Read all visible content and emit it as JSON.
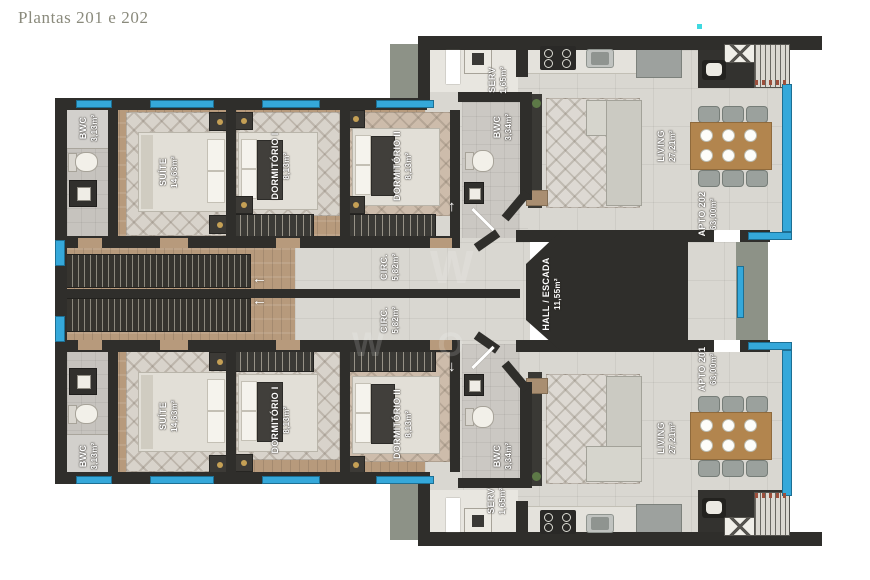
{
  "title": "Plantas 201 e 202",
  "watermark": {
    "emblem": "W",
    "letters": "W O"
  },
  "colors": {
    "wall": "#2f2e2b",
    "glass_blue": "#35a8da",
    "wood_floor": "#b79a7c",
    "tile_floor": "#d9d7d1",
    "concrete": "#a0a599",
    "table_wood": "#b2854e",
    "title_text": "#8a8a7c"
  },
  "units": {
    "apto_202": {
      "name": "APTO 202",
      "area": "63,00m²"
    },
    "apto_201": {
      "name": "APTO 201",
      "area": "63,00m²"
    }
  },
  "rooms": {
    "suite": {
      "name": "SUÍTE",
      "area": "14,63m²"
    },
    "dormitorio1": {
      "name": "DORMITÓRIO I",
      "area": "8,13m²"
    },
    "dormitorio2": {
      "name": "DORMITÓRIO II",
      "area": "8,13m²"
    },
    "bwc_suite": {
      "name": "BWC",
      "area": "3,13m²"
    },
    "bwc_social": {
      "name": "BWC",
      "area": "3,34m²"
    },
    "serv": {
      "name": "SERV",
      "area": "1,65m²"
    },
    "living": {
      "name": "LIVING",
      "area": "27,21m²"
    },
    "circ": {
      "name": "CIRC.",
      "area": "5,82m²"
    },
    "hall_escada": {
      "name": "HALL / ESCADA",
      "area": "11,55m²"
    }
  }
}
